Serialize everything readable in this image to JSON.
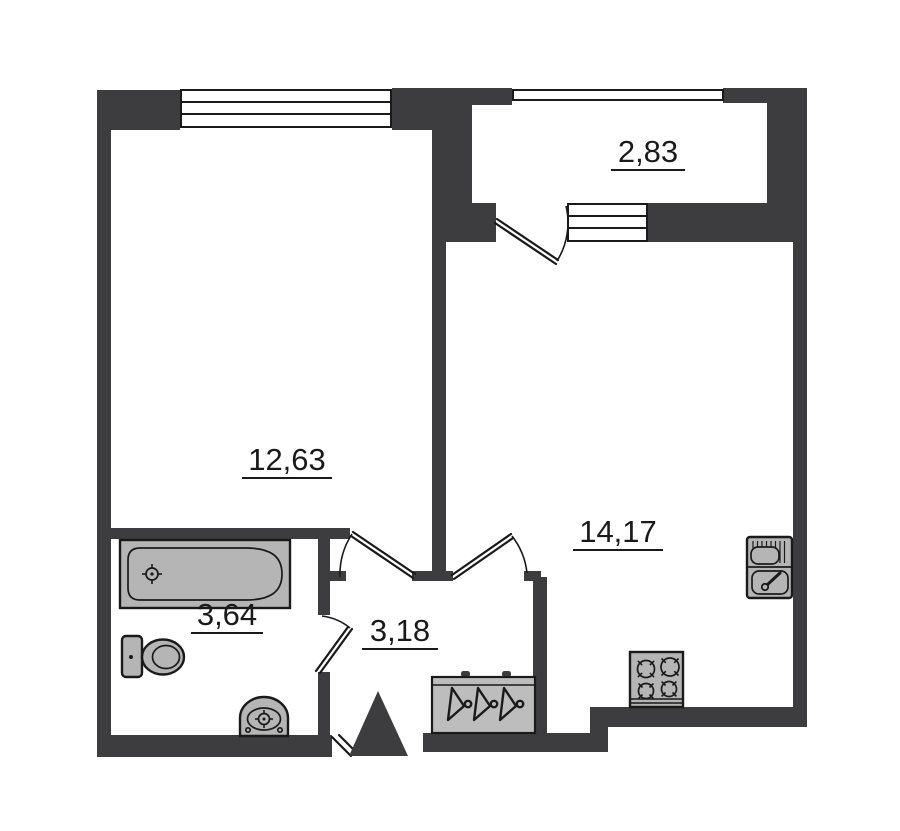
{
  "plan_title": "one-room apartment floor plan",
  "rooms": {
    "living_room": {
      "area": "12,63"
    },
    "balcony": {
      "area": "2,83"
    },
    "kitchen": {
      "area": "14,17"
    },
    "bathroom": {
      "area": "3,64"
    },
    "hallway": {
      "area": "3,18"
    }
  },
  "fixtures": {
    "bathtub": "bathtub-icon",
    "toilet": "toilet-icon",
    "washbasin": "washbasin-icon",
    "kitchen_sink": "kitchen-sink-icon",
    "stove": "stove-icon",
    "wardrobe": "wardrobe-icon",
    "entrance_marker": "entrance-triangle-icon"
  },
  "colors": {
    "wall": "#3d3d3f",
    "outline": "#1a1a1a",
    "fixture": "#b5b5b5",
    "wardrobe": "#bdbdbd",
    "background": "#ffffff",
    "label": "#1a1a1a"
  }
}
